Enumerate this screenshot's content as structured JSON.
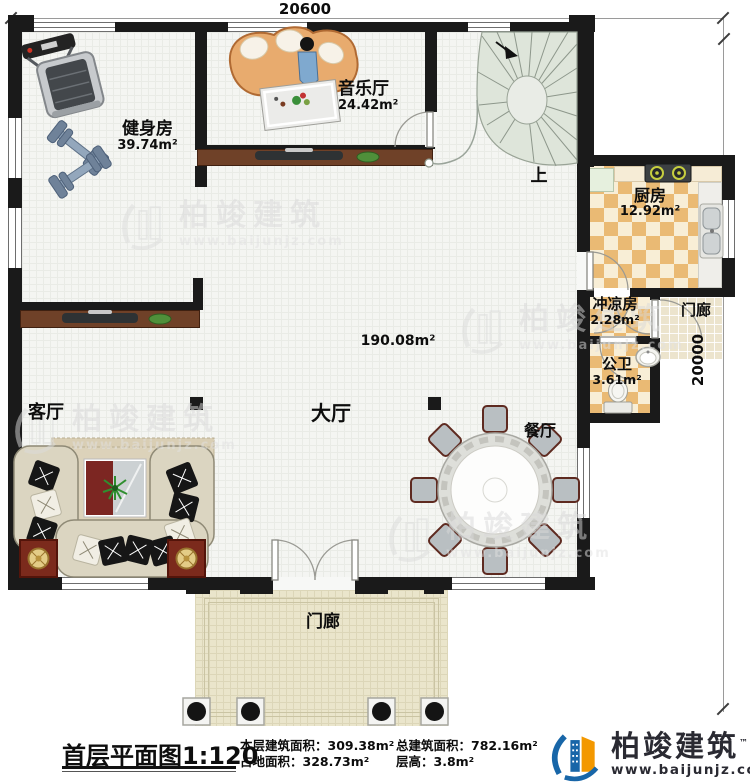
{
  "dimensions": {
    "top": "20600",
    "right": "20000"
  },
  "rooms": {
    "gym": {
      "name": "健身房",
      "area": "39.74m²"
    },
    "music": {
      "name": "音乐厅",
      "area": "24.42m²"
    },
    "kitchen": {
      "name": "厨房",
      "area": "12.92m²"
    },
    "shower": {
      "name": "冲凉房",
      "area": "2.28m²"
    },
    "toilet": {
      "name": "公卫",
      "area": "3.61m²"
    },
    "hall": {
      "name": "大厅",
      "area": "190.08m²"
    },
    "living": {
      "name": "客厅"
    },
    "dining": {
      "name": "餐厅"
    },
    "porch_bottom": {
      "name": "门廊"
    },
    "porch_right": {
      "name": "门廊"
    },
    "stairs": {
      "label": "上"
    }
  },
  "title_block": {
    "title": "首层平面图",
    "scale": "1:120",
    "stats": [
      {
        "label": "本层建筑面积：",
        "value": "309.38m²"
      },
      {
        "label": "占地面积：",
        "value": "328.73m²"
      },
      {
        "label": "总建筑面积：",
        "value": "782.16m²"
      },
      {
        "label": "层高：",
        "value": "3.8m²"
      }
    ],
    "logo": {
      "name": "柏竣建筑",
      "url": "www.baijunjz.com",
      "trademark": "™"
    }
  },
  "watermark": {
    "name": "柏竣建筑",
    "url": "www.baijunjz.com"
  },
  "colors": {
    "wall": "#1a1a1a",
    "floor": "#f4f5f2",
    "porch": "#eae5cb",
    "tile_orange": "#eaba74",
    "tile_cream": "#f8eed6",
    "stair": "#dee5da",
    "wood": "#6f4128",
    "logo_blue": "#1866a8",
    "logo_orange": "#f39800"
  }
}
